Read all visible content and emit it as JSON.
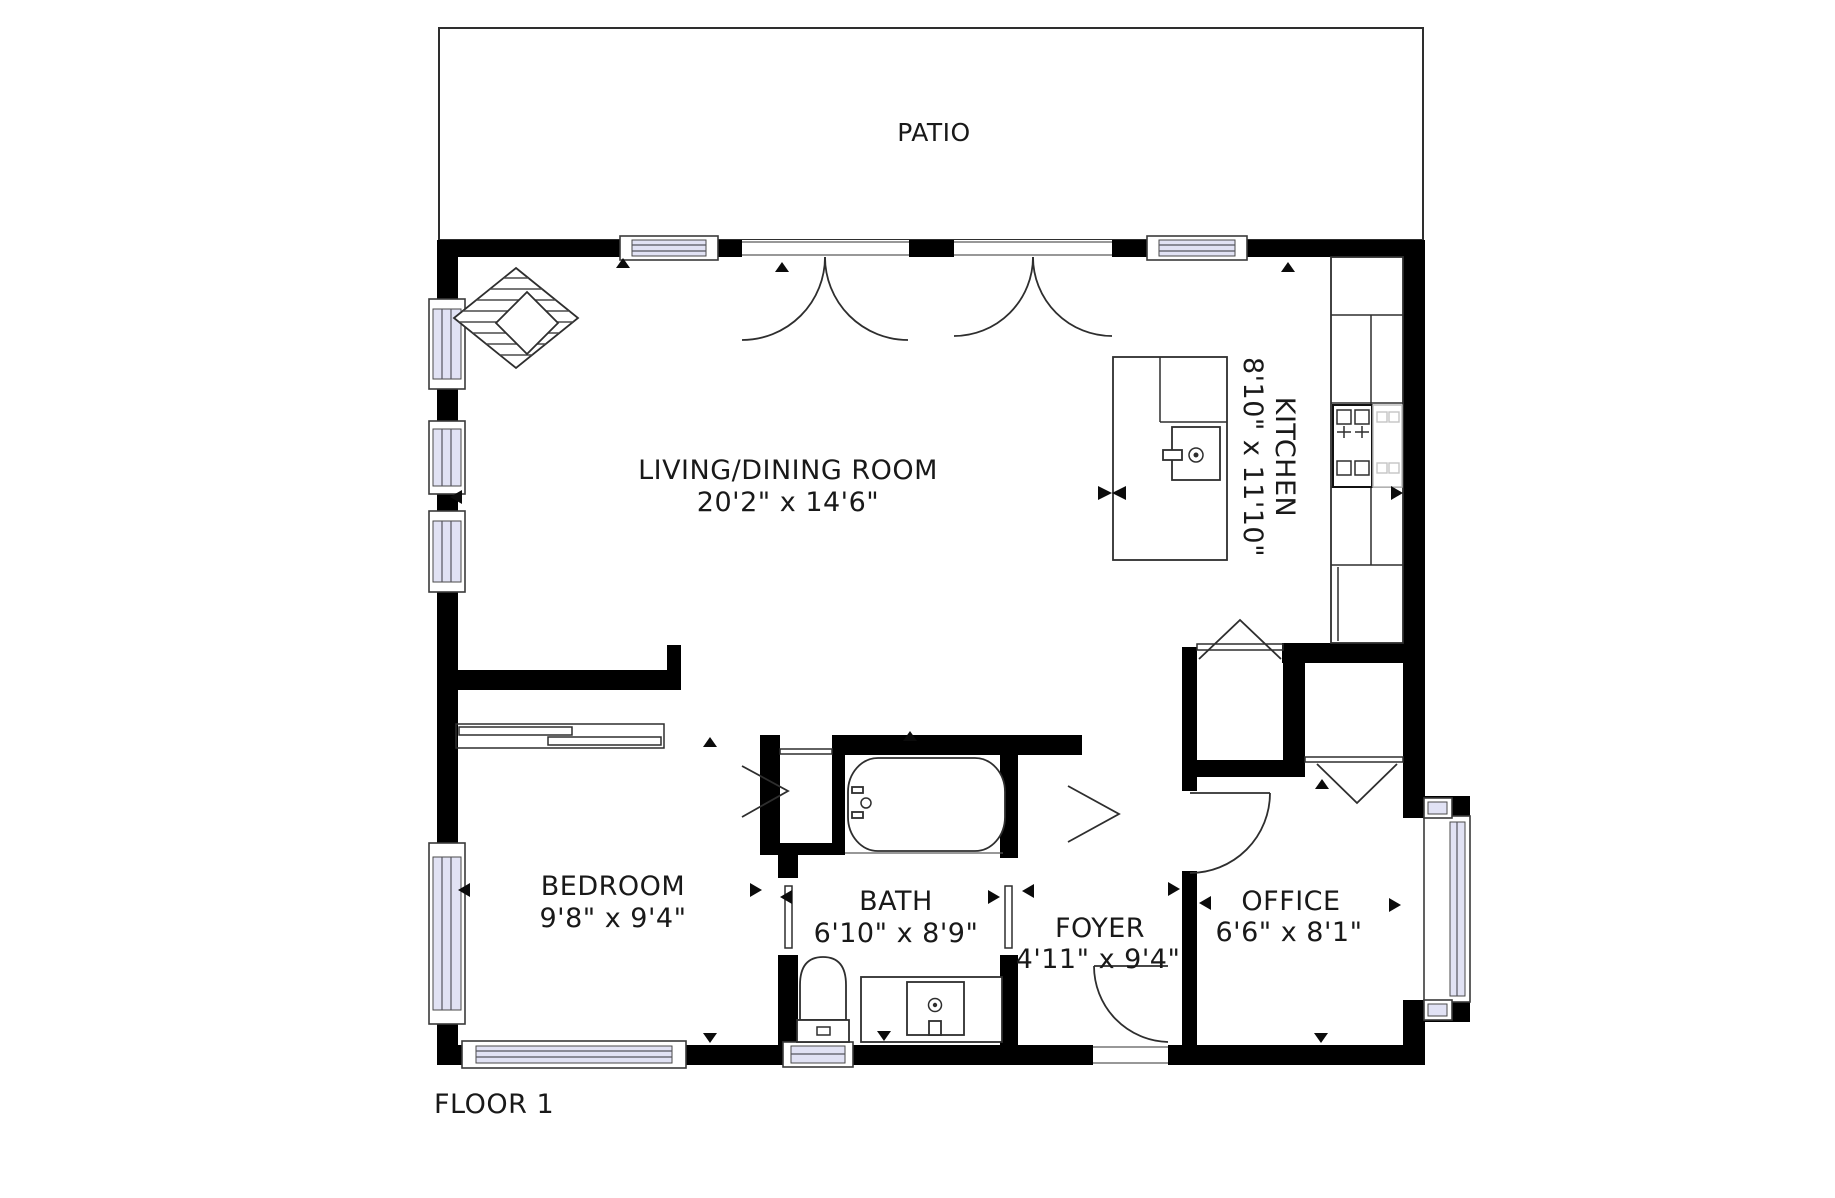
{
  "floor_plan": {
    "floor_label": "FLOOR 1",
    "rooms": {
      "patio": {
        "name": "PATIO"
      },
      "living_dining": {
        "name": "LIVING/DINING ROOM",
        "dimensions": "20'2\" x 14'6\""
      },
      "kitchen": {
        "name": "KITCHEN",
        "dimensions": "8'10\" x 11'10\""
      },
      "bedroom": {
        "name": "BEDROOM",
        "dimensions": "9'8\" x 9'4\""
      },
      "bath": {
        "name": "BATH",
        "dimensions": "6'10\" x 8'9\""
      },
      "foyer": {
        "name": "FOYER",
        "dimensions": "4'11\" x 9'4\""
      },
      "office": {
        "name": "OFFICE",
        "dimensions": "6'6\" x 8'1\""
      }
    },
    "colors": {
      "wall": "#000000",
      "window_glass": "#e1e2f4",
      "line": "#2e2e2e",
      "background": "#ffffff"
    }
  }
}
